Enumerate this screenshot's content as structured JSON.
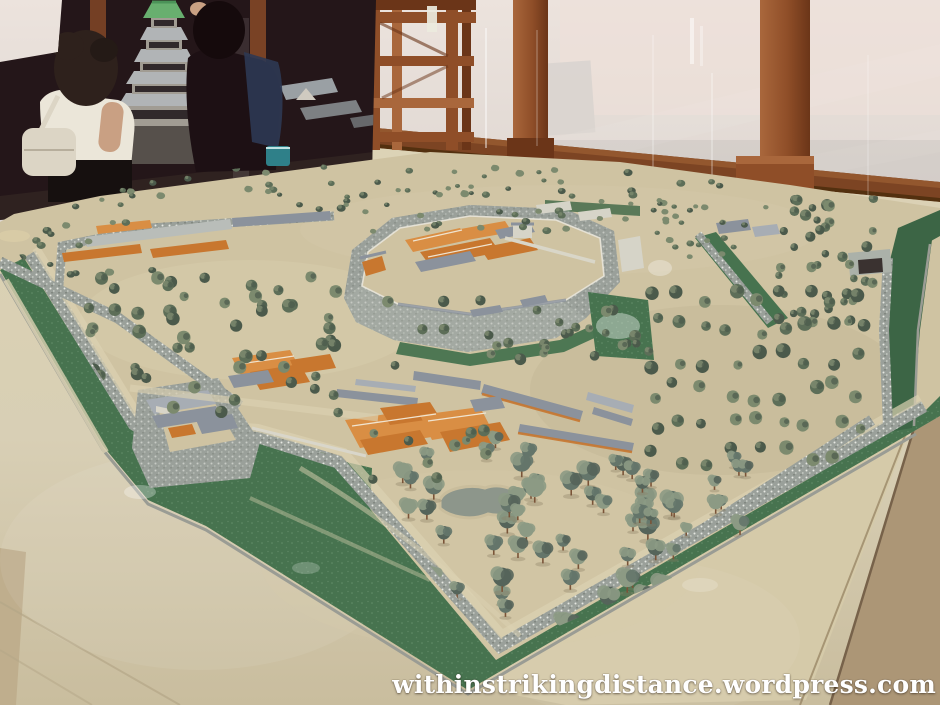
{
  "watermark": {
    "text": "withinstrikingdistance.wordpress.com"
  },
  "scene": {
    "setting": "museum exhibit room with wooden pillars and glass display cases",
    "subject": "large scale diorama of a Japanese castle town with zigzag moats, stone walls, palace buildings, gates and pine groves",
    "background": {
      "keep_model": "multi-tiered castle keep model with grey roofs and green gabled top roof",
      "visitors": [
        "woman with dark curly hair, white top and white shoulder bag",
        "visitor in dark clothes raising an arm to photograph the keep model"
      ],
      "structures": [
        "timber display frame",
        "wooden pillars",
        "glass case panels",
        "wooden baseboard rail",
        "leaning white panel"
      ]
    },
    "diorama_features": [
      "outer green moat with speckled stone banks",
      "central honmaru compound with stone walls and orange palace roofs",
      "masugata gate enclosure with corner turret",
      "long barracks rows with slate roofs",
      "pine orchard in rows",
      "small grey pond",
      "rear tunnel gate across east moat"
    ]
  },
  "palette": {
    "wallTop": "#ece3dd",
    "wallBottom": "#d5cec9",
    "wallShade": "#c6c0bd",
    "wood": "#8f4e28",
    "woodDark": "#6b3518",
    "woodLight": "#a9673c",
    "rail": "#7c4423",
    "darkScene": "#241619",
    "table": "#d8cfb5",
    "tableDark": "#c9bd9e",
    "tableEdge": "#ac9676",
    "apron": "#d5caa9",
    "sand": "#cfc3a2",
    "sandLight": "#dcd2b2",
    "sandDark": "#bfb292",
    "moat": "#47734f",
    "moatDark": "#3c6545",
    "stone": "#9aa09a",
    "stoneBright": "#abb1a9",
    "stoneDark": "#767c74",
    "parapet": "#e9e6da",
    "roofGrey": "#8b929c",
    "roofGreyLight": "#a7adb4",
    "orange": "#c8772f",
    "orangeLight": "#d98e44",
    "orangeDark": "#a75f24",
    "whiteBldg": "#d6d4c8",
    "treeDark": "#4b5a4b",
    "tree": "#5d6e58",
    "treeLight": "#7c8a6e",
    "pine": "#64756a",
    "pineLight": "#8c9a84",
    "trunk": "#7a5438",
    "keepGrey": "#b9bdbf",
    "keepDark": "#322b2c",
    "keepGreen": "#6cb874",
    "skin": "#c9a083",
    "shirt": "#ebe6d9",
    "bag": "#dcd5c5",
    "navy": "#2e3953",
    "teal": "#2f8089",
    "pond": "#8d968b"
  },
  "tree_clusters": [
    {
      "name": "back-border",
      "x": 70,
      "y": 166,
      "w": 660,
      "h": 46,
      "n": 64,
      "rmin": 2.5,
      "rmax": 4.5,
      "type": "bush",
      "seed": 11
    },
    {
      "name": "back-right-grove",
      "x": 775,
      "y": 198,
      "w": 130,
      "h": 130,
      "n": 42,
      "rmin": 3.5,
      "rmax": 6,
      "type": "tree",
      "seed": 12
    },
    {
      "name": "right-garden-hedges",
      "x": 655,
      "y": 200,
      "w": 120,
      "h": 62,
      "n": 26,
      "rmin": 2.5,
      "rmax": 4,
      "type": "bush",
      "seed": 13
    },
    {
      "name": "left-outer",
      "x": 12,
      "y": 222,
      "w": 150,
      "h": 55,
      "n": 16,
      "rmin": 3,
      "rmax": 5,
      "type": "bush",
      "seed": 14
    },
    {
      "name": "west-grove",
      "x": 75,
      "y": 275,
      "w": 270,
      "h": 140,
      "n": 56,
      "rmin": 4.5,
      "rmax": 7,
      "type": "tree",
      "seed": 15
    },
    {
      "name": "center-scatter",
      "x": 335,
      "y": 300,
      "w": 320,
      "h": 70,
      "n": 18,
      "rmin": 4,
      "rmax": 6,
      "type": "tree",
      "seed": 16
    },
    {
      "name": "honmaru-back-trees",
      "x": 345,
      "y": 210,
      "w": 320,
      "h": 28,
      "n": 16,
      "rmin": 3,
      "rmax": 4.5,
      "type": "bush",
      "seed": 17
    },
    {
      "name": "honmaru-front-trees",
      "x": 470,
      "y": 325,
      "w": 190,
      "h": 38,
      "n": 11,
      "rmin": 3.5,
      "rmax": 5.5,
      "type": "tree",
      "seed": 18
    },
    {
      "name": "front-grove",
      "x": 300,
      "y": 448,
      "w": 220,
      "h": 180,
      "n": 30,
      "rmin": 6,
      "rmax": 9,
      "type": "pine",
      "seed": 19
    },
    {
      "name": "front-grove-east",
      "x": 490,
      "y": 460,
      "w": 190,
      "h": 185,
      "n": 38,
      "rmin": 6,
      "rmax": 10,
      "type": "pine",
      "seed": 20
    },
    {
      "name": "east-orchard",
      "x": 640,
      "y": 278,
      "w": 235,
      "h": 195,
      "n": 54,
      "rmin": 4.5,
      "rmax": 7.5,
      "type": "tree",
      "rows": true,
      "seed": 21
    },
    {
      "name": "east-front-pines",
      "x": 615,
      "y": 465,
      "w": 160,
      "h": 105,
      "n": 16,
      "rmin": 5,
      "rmax": 8,
      "type": "pine",
      "seed": 22
    },
    {
      "name": "palace-south-trees",
      "x": 360,
      "y": 430,
      "w": 150,
      "h": 50,
      "n": 10,
      "rmin": 4,
      "rmax": 6,
      "type": "tree",
      "seed": 23
    }
  ]
}
